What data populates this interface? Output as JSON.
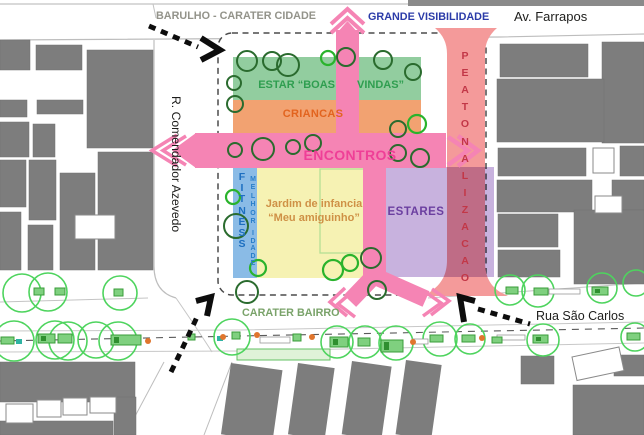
{
  "labels": {
    "top_left": "BARULHO - CARATER CIDADE",
    "top_center": "GRANDE VISIBILIDADE",
    "top_right_street": "Av. Farrapos",
    "left_street": "R. Comendador Azevedo",
    "bottom_center": "CARATER BAIRRO",
    "bottom_right_street": "Rua São Carlos"
  },
  "zones": {
    "estar": {
      "label": "ESTAR “BOAS VINDAS”",
      "label_left": "ESTAR “BOAS",
      "label_right": "VINDAS”",
      "color": "#92cd9f",
      "text_color": "#2f9e50"
    },
    "criancas": {
      "label": "CRIANCAS",
      "color": "#f2a271",
      "text_color": "#e2641f"
    },
    "encontros": {
      "label": "ENCONTROS",
      "color": "#f584b4",
      "text_color": "#ef3f97"
    },
    "fitness": {
      "label": "FITNESS",
      "color": "#8abbe6",
      "text_color": "#1d6fc0"
    },
    "melhor_idade": {
      "label": "MELHOR IDADE",
      "text_color": "#2a7fc9"
    },
    "jardim": {
      "line1": "Jardim de infancia",
      "line2": "“Meu amiguinho”",
      "color": "#f6f2b3",
      "text_color": "#cf9146"
    },
    "estares": {
      "label": "ESTARES",
      "color": "#b49cd1",
      "text_color": "#6b3fa0"
    },
    "peatonalizacao": {
      "label": "PEATONALIZACAO",
      "color": "#f49a9a",
      "text_color": "#c23747"
    }
  },
  "vertical_texts": [
    {
      "name": "fitness-label",
      "text": "FITNESS",
      "x": 235,
      "y": 171,
      "step": 11.2,
      "class": "vt-fitness"
    },
    {
      "name": "melhor-label",
      "text": "MELHOR",
      "x": 246,
      "y": 176,
      "step": 8.4,
      "class": "vt-melhor"
    },
    {
      "name": "idade-label",
      "text": "IDADE",
      "x": 246,
      "y": 230,
      "step": 7.6,
      "class": "vt-melhor"
    },
    {
      "name": "peatonalizacao-label",
      "text": "PEATONALIZACAO",
      "x": 458,
      "y": 50,
      "step": 17.1,
      "class": "vt-peaton"
    }
  ],
  "map_shapes": {
    "colors": {
      "pink": "#f584b4",
      "red_band": "#f49a9a",
      "purple": "#9a72c2",
      "building": "#7d7d7d",
      "tree_dark": "#2a6b2e",
      "tree_bright": "#2ab32c",
      "street_tree": "#4ed45e",
      "planter_fill": "#7fd07f",
      "planter_stroke": "#3a9c3a",
      "orange_dot": "#e0752d",
      "teal": "#2fb3a3",
      "black": "#0d0d0d"
    },
    "street_lines": [
      {
        "d": "M0,4 L644,4",
        "c": "#c2c2c2",
        "w": 1.2
      },
      {
        "d": "M153,4 L156,18",
        "c": "#c2c2c2",
        "w": 1
      },
      {
        "d": "M0,40 L500,37 L644,34",
        "c": "#bdbdbd",
        "w": 1.2
      },
      {
        "d": "M154,40 L154,266 Q154,292 176,298",
        "c": "#bdbdbd",
        "w": 1.2
      },
      {
        "d": "M176,298 Q198,330 212,352",
        "c": "#c6c6c6",
        "w": 1
      },
      {
        "d": "M0,302 L148,298",
        "c": "#c4c4c4",
        "w": 1
      },
      {
        "d": "M428,298 L644,283",
        "c": "#c4c4c4",
        "w": 1
      },
      {
        "d": "M0,331 L240,330 L644,322",
        "c": "#c8c8c8",
        "w": 1
      },
      {
        "d": "M0,352 L240,351 L644,343",
        "c": "#c8c8c8",
        "w": 1
      },
      {
        "d": "M0,341 L240,336 L644,328",
        "c": "#5a5a5a",
        "w": 1.1,
        "dash": "7 6"
      },
      {
        "d": "M125,435 L164,362",
        "c": "#bdbdbd",
        "w": 1
      },
      {
        "d": "M204,435 L232,362",
        "c": "#bdbdbd",
        "w": 1
      }
    ],
    "top_strip": {
      "x": 408,
      "y": 0,
      "w": 236,
      "h": 6
    },
    "buildings": [
      {
        "x": 0,
        "y": 40,
        "w": 30,
        "h": 30
      },
      {
        "x": 36,
        "y": 45,
        "w": 46,
        "h": 25
      },
      {
        "x": 87,
        "y": 50,
        "w": 66,
        "h": 98
      },
      {
        "x": 0,
        "y": 100,
        "w": 27,
        "h": 17
      },
      {
        "x": 37,
        "y": 100,
        "w": 46,
        "h": 14
      },
      {
        "x": 0,
        "y": 122,
        "w": 29,
        "h": 35
      },
      {
        "x": 33,
        "y": 124,
        "w": 22,
        "h": 33
      },
      {
        "x": 0,
        "y": 160,
        "w": 26,
        "h": 47
      },
      {
        "x": 29,
        "y": 160,
        "w": 27,
        "h": 60
      },
      {
        "x": 60,
        "y": 173,
        "w": 35,
        "h": 97
      },
      {
        "x": 98,
        "y": 152,
        "w": 55,
        "h": 118
      },
      {
        "x": 0,
        "y": 212,
        "w": 21,
        "h": 58
      },
      {
        "x": 28,
        "y": 225,
        "w": 25,
        "h": 45
      },
      {
        "x": 500,
        "y": 44,
        "w": 88,
        "h": 33
      },
      {
        "x": 602,
        "y": 42,
        "w": 42,
        "h": 101
      },
      {
        "x": 497,
        "y": 79,
        "w": 107,
        "h": 63
      },
      {
        "x": 498,
        "y": 148,
        "w": 88,
        "h": 28
      },
      {
        "x": 620,
        "y": 146,
        "w": 24,
        "h": 30
      },
      {
        "x": 497,
        "y": 180,
        "w": 95,
        "h": 32
      },
      {
        "x": 612,
        "y": 180,
        "w": 32,
        "h": 30
      },
      {
        "x": 498,
        "y": 214,
        "w": 60,
        "h": 33
      },
      {
        "x": 574,
        "y": 210,
        "w": 70,
        "h": 74
      },
      {
        "x": 498,
        "y": 250,
        "w": 62,
        "h": 27
      },
      {
        "x": 0,
        "y": 362,
        "w": 135,
        "h": 40
      },
      {
        "x": 0,
        "y": 421,
        "w": 113,
        "h": 14
      },
      {
        "x": 114,
        "y": 397,
        "w": 22,
        "h": 38
      },
      {
        "x": 521,
        "y": 356,
        "w": 33,
        "h": 28
      },
      {
        "x": 614,
        "y": 355,
        "w": 30,
        "h": 21
      },
      {
        "x": 573,
        "y": 385,
        "w": 71,
        "h": 50
      }
    ],
    "rot_buildings": [
      {
        "x": 231,
        "y": 363,
        "w": 52,
        "h": 72,
        "r": 8
      },
      {
        "x": 298,
        "y": 363,
        "w": 37,
        "h": 72,
        "r": 8
      },
      {
        "x": 352,
        "y": 361,
        "w": 40,
        "h": 74,
        "r": 8
      },
      {
        "x": 406,
        "y": 360,
        "w": 36,
        "h": 75,
        "r": 8
      }
    ],
    "white_buildings": [
      {
        "x": 75,
        "y": 215,
        "w": 40,
        "h": 24
      },
      {
        "x": 593,
        "y": 148,
        "w": 21,
        "h": 25
      },
      {
        "x": 595,
        "y": 196,
        "w": 27,
        "h": 17
      },
      {
        "x": 6,
        "y": 404,
        "w": 27,
        "h": 19
      },
      {
        "x": 37,
        "y": 400,
        "w": 24,
        "h": 17
      },
      {
        "x": 63,
        "y": 398,
        "w": 24,
        "h": 17
      },
      {
        "x": 90,
        "y": 397,
        "w": 26,
        "h": 16
      },
      {
        "x": 572,
        "y": 357,
        "w": 48,
        "h": 24,
        "r": -12
      }
    ],
    "block": {
      "x": 218,
      "y": 33,
      "w": 268,
      "h": 262,
      "rx": 14,
      "stroke": "#4b4b4b",
      "dash": "6 4.5"
    },
    "zone_rects": [
      {
        "x": 233,
        "y": 57,
        "w": 188,
        "h": 43,
        "fill": "#92cd9f"
      },
      {
        "x": 233,
        "y": 100,
        "w": 188,
        "h": 33,
        "fill": "#f2a271"
      },
      {
        "x": 233,
        "y": 168,
        "w": 24,
        "h": 110,
        "fill": "#8abbe6"
      },
      {
        "x": 257,
        "y": 168,
        "w": 106,
        "h": 110,
        "fill": "#f6f2b3"
      },
      {
        "x": 320,
        "y": 169,
        "w": 44,
        "h": 84,
        "fill": "none",
        "stroke": "#b5df95"
      }
    ],
    "red_band_path": "M435,28 C443,35 447,43 447,54 L447,260 C447,274 442,284 430,292 Q426,294 422,296 L508,296 Q504,294 500,292 C488,284 485,274 485,260 L485,54 C485,43 489,35 497,28 Z",
    "purple_rect": {
      "x": 386,
      "y": 167,
      "w": 108,
      "h": 110,
      "opacity": 0.55
    },
    "pink_fills": [
      {
        "type": "rect",
        "x": 336,
        "y": 30,
        "w": 23,
        "h": 103
      },
      {
        "type": "poly",
        "pts": "336,34 347.5,21 359,34"
      },
      {
        "type": "rect",
        "x": 195,
        "y": 133,
        "w": 251,
        "h": 35
      },
      {
        "type": "poly",
        "pts": "196,133 172,150.5 196,168"
      },
      {
        "type": "rect",
        "x": 363,
        "y": 168,
        "w": 23,
        "h": 112
      },
      {
        "type": "poly",
        "pts": "363,268 386,268 386,282 363,282"
      }
    ],
    "pink_strokes": [
      {
        "d": "M331,24 L347.5,9 L364,24",
        "w": 4
      },
      {
        "d": "M331,33 L347.5,18 L364,33",
        "w": 4
      },
      {
        "d": "M186,136 L163,150.5 L186,165",
        "w": 3.5
      },
      {
        "d": "M177,135 L152,150.5 L177,166",
        "w": 3.5
      },
      {
        "d": "M448,137 L468,150.5 L448,165",
        "w": 4.5
      },
      {
        "d": "M458,136 L478,150.5 L458,166",
        "w": 4.5
      },
      {
        "d": "M374,276 L350,301",
        "w": 17
      },
      {
        "d": "M374,276 L426,299",
        "w": 17
      },
      {
        "d": "M353,291 L338,304 L355,317",
        "w": 3.5
      },
      {
        "d": "M345,288 L330,302 L347,316",
        "w": 3.5
      },
      {
        "d": "M424,291 L441,303 L423,316",
        "w": 3.5
      },
      {
        "d": "M432,289 L449,301 L431,315",
        "w": 3.5
      }
    ],
    "grass_strip": {
      "x": 237,
      "y": 349,
      "w": 93,
      "h": 11,
      "fill": "#dff2d8",
      "stroke": "#63c063"
    },
    "trees_dark": [
      [
        247,
        61,
        10
      ],
      [
        234,
        83,
        7
      ],
      [
        235,
        104,
        8
      ],
      [
        272,
        61,
        9
      ],
      [
        288,
        65,
        11
      ],
      [
        346,
        57,
        9
      ],
      [
        383,
        60,
        9
      ],
      [
        413,
        72,
        8
      ],
      [
        235,
        150,
        7
      ],
      [
        263,
        149,
        11
      ],
      [
        293,
        147,
        7
      ],
      [
        313,
        143,
        8
      ],
      [
        398,
        129,
        8
      ],
      [
        398,
        153,
        8
      ],
      [
        420,
        158,
        9
      ],
      [
        236,
        226,
        12
      ],
      [
        247,
        292,
        11
      ],
      [
        371,
        258,
        10
      ],
      [
        377,
        290,
        9
      ]
    ],
    "trees_bright": [
      [
        328,
        58,
        7
      ],
      [
        417,
        124,
        9
      ],
      [
        233,
        197,
        7
      ],
      [
        258,
        268,
        8
      ],
      [
        333,
        270,
        10
      ],
      [
        350,
        263,
        8
      ]
    ],
    "street_trees": [
      [
        22,
        293,
        19
      ],
      [
        48,
        292,
        19
      ],
      [
        120,
        293,
        17
      ],
      [
        14,
        341,
        20
      ],
      [
        55,
        340,
        19
      ],
      [
        68,
        341,
        19
      ],
      [
        96,
        340,
        18
      ],
      [
        118,
        341,
        19
      ],
      [
        232,
        337,
        18
      ],
      [
        337,
        342,
        16
      ],
      [
        365,
        342,
        16
      ],
      [
        396,
        343,
        17
      ],
      [
        440,
        339,
        17
      ],
      [
        470,
        339,
        15
      ],
      [
        543,
        340,
        16
      ],
      [
        635,
        337,
        14
      ],
      [
        510,
        290,
        15
      ],
      [
        538,
        291,
        16
      ],
      [
        602,
        288,
        15
      ],
      [
        636,
        283,
        13
      ]
    ],
    "platforms": [
      {
        "x": 260,
        "y": 337,
        "w": 30,
        "h": 6
      },
      {
        "x": 412,
        "y": 339,
        "w": 16,
        "h": 5
      },
      {
        "x": 549,
        "y": 289,
        "w": 31,
        "h": 5
      },
      {
        "x": 497,
        "y": 335,
        "w": 28,
        "h": 5
      }
    ],
    "planters": [
      {
        "x": 34,
        "y": 288,
        "w": 10,
        "h": 7
      },
      {
        "x": 55,
        "y": 288,
        "w": 10,
        "h": 7
      },
      {
        "x": 114,
        "y": 289,
        "w": 9,
        "h": 7
      },
      {
        "x": 1,
        "y": 337,
        "w": 13,
        "h": 7
      },
      {
        "x": 38,
        "y": 334,
        "w": 17,
        "h": 9
      },
      {
        "x": 58,
        "y": 334,
        "w": 14,
        "h": 9
      },
      {
        "x": 111,
        "y": 335,
        "w": 30,
        "h": 10
      },
      {
        "x": 188,
        "y": 334,
        "w": 7,
        "h": 6
      },
      {
        "x": 232,
        "y": 332,
        "w": 8,
        "h": 7
      },
      {
        "x": 293,
        "y": 334,
        "w": 8,
        "h": 7
      },
      {
        "x": 330,
        "y": 337,
        "w": 18,
        "h": 10
      },
      {
        "x": 358,
        "y": 338,
        "w": 12,
        "h": 8
      },
      {
        "x": 381,
        "y": 340,
        "w": 22,
        "h": 12
      },
      {
        "x": 430,
        "y": 335,
        "w": 13,
        "h": 7
      },
      {
        "x": 462,
        "y": 335,
        "w": 13,
        "h": 7
      },
      {
        "x": 492,
        "y": 337,
        "w": 10,
        "h": 6
      },
      {
        "x": 533,
        "y": 335,
        "w": 15,
        "h": 8
      },
      {
        "x": 506,
        "y": 287,
        "w": 12,
        "h": 7
      },
      {
        "x": 534,
        "y": 288,
        "w": 14,
        "h": 7
      },
      {
        "x": 592,
        "y": 287,
        "w": 16,
        "h": 8
      },
      {
        "x": 627,
        "y": 333,
        "w": 13,
        "h": 7
      }
    ],
    "teal_squares": [
      [
        16,
        339,
        6,
        5
      ],
      [
        217,
        336,
        6,
        5
      ]
    ],
    "orange_dots": [
      [
        148,
        341
      ],
      [
        223,
        337
      ],
      [
        257,
        335
      ],
      [
        312,
        337
      ],
      [
        413,
        342
      ],
      [
        482,
        338
      ]
    ],
    "black_arrow_dashes": [
      {
        "d": "M149,26 L198,47"
      },
      {
        "d": "M171,372 Q186,341 197,317"
      },
      {
        "d": "M478,309 L530,324"
      }
    ],
    "black_arrow_heads": [
      {
        "d": "M201,38 L220,50 L201,60"
      },
      {
        "d": "M196,301 L211,297 L207,316"
      },
      {
        "d": "M475,301 L460,297 L464,322"
      }
    ]
  }
}
